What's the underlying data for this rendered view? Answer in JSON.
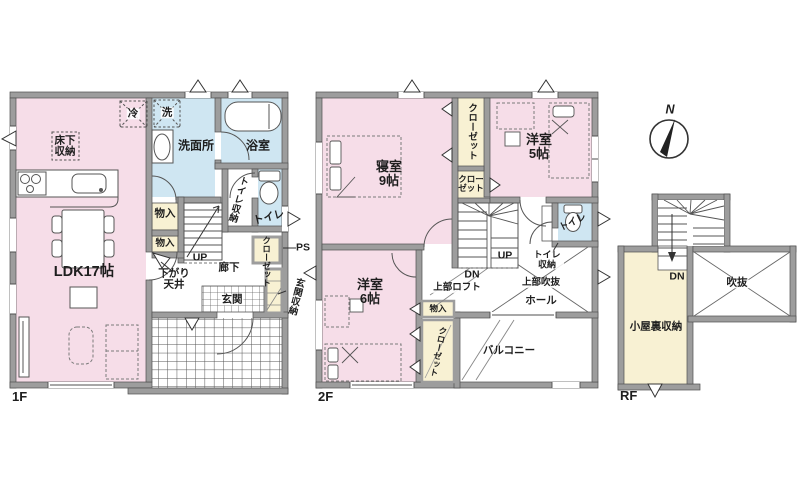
{
  "compass": {
    "north": "N"
  },
  "floors": {
    "f1": {
      "name": "1F",
      "rooms": {
        "ldk": "LDK17帖",
        "underfloor_storage": "床下収納",
        "fridge": "冷",
        "washer": "洗",
        "washroom": "洗面所",
        "bath": "浴室",
        "toilet": "トイレ",
        "toilet_storage": "トイレ収納",
        "closet": "クローゼット",
        "pipe_space": "PS",
        "storage_a": "物入",
        "storage_b": "物入",
        "stairs_up": "UP",
        "lowered_ceiling": "下がり天井",
        "hallway": "廊下",
        "entrance": "玄関",
        "entrance_storage": "玄関収納"
      }
    },
    "f2": {
      "name": "2F",
      "rooms": {
        "bedroom": "寝室9帖",
        "closet_tall": "クローゼット",
        "closet_small": "クローゼット",
        "western5": "洋室5帖",
        "toilet": "トイレ",
        "toilet_storage": "トイレ収納",
        "stairs_up": "UP",
        "stairs_down": "DN",
        "loft_above": "上部ロフト",
        "void_above": "上部吹抜",
        "hall": "ホール",
        "storage": "物入",
        "closet_low": "クローゼット",
        "western6": "洋室6帖",
        "balcony": "バルコニー"
      }
    },
    "rf": {
      "name": "RF",
      "rooms": {
        "stairs_down": "DN",
        "void": "吹抜",
        "attic_storage": "小屋裏収納"
      }
    }
  },
  "colors": {
    "room_pink": "#f6dde8",
    "wet_blue": "#cfe6f2",
    "closet_cream": "#f8f1d3",
    "wall_gray": "#9d9d9d"
  }
}
